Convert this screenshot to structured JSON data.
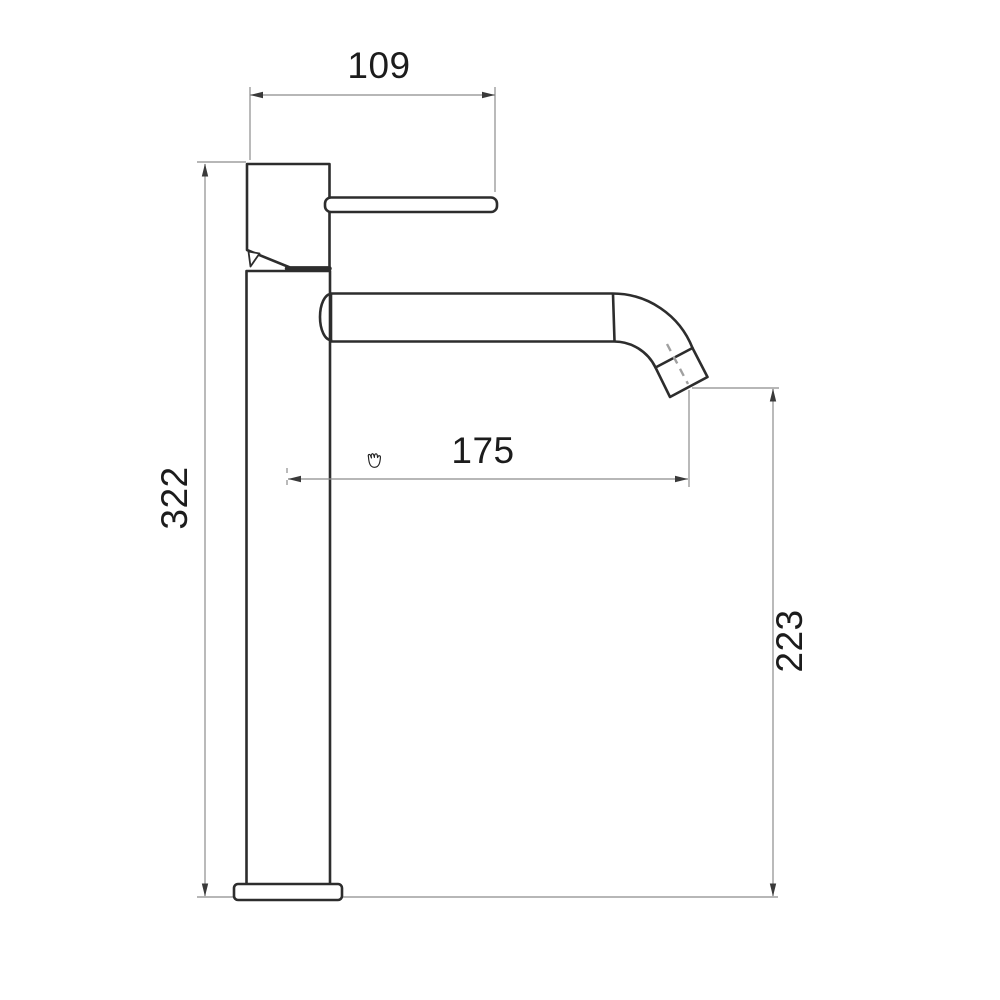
{
  "drawing": {
    "dimensions": {
      "handle_width": "109",
      "overall_height": "322",
      "spout_reach": "175",
      "outlet_height": "223"
    },
    "colors": {
      "outline": "#2d2d2d",
      "dimension_lines": "#8c8c8c",
      "arrowheads": "#3a3a3a",
      "text": "#1c1c1c",
      "flow_axis": "#a0a0a0",
      "background": "#ffffff"
    }
  },
  "cursor": {
    "name": "hand-grab-cursor"
  }
}
